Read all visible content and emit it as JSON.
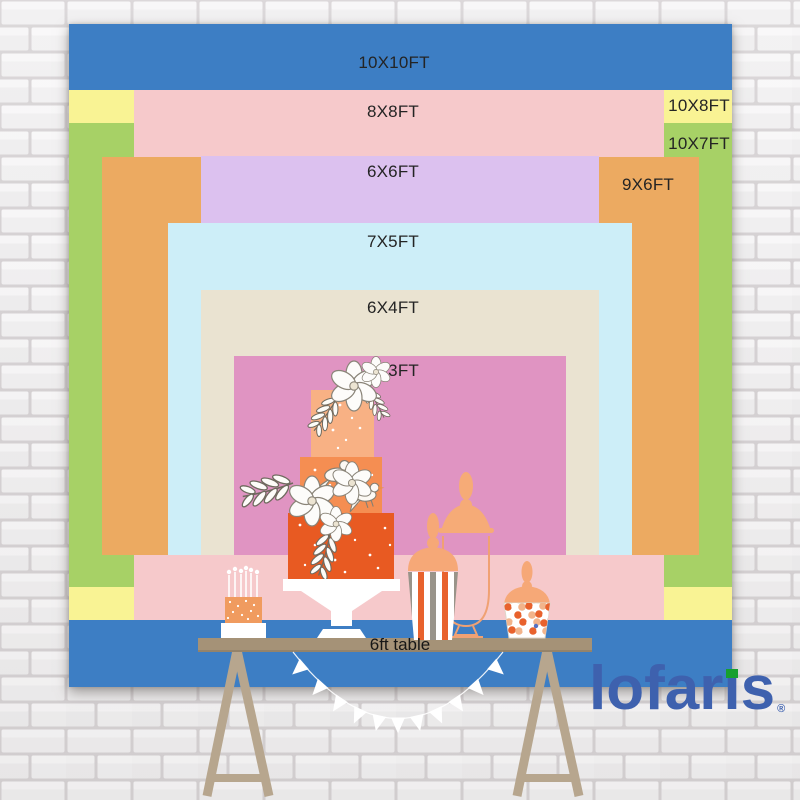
{
  "title": "Backdrop size comparison chart",
  "backdrops": [
    {
      "id": "10x10ft",
      "label": "10X10FT",
      "color": "#3d7ec4",
      "x": 69,
      "y": 24,
      "w": 663,
      "h": 663,
      "lx": 394,
      "ly": 63
    },
    {
      "id": "10x8ft",
      "label": "10X8FT",
      "color": "#f9f394",
      "x": 69,
      "y": 90,
      "w": 663,
      "h": 530,
      "lx": 699,
      "ly": 106
    },
    {
      "id": "10x7ft",
      "label": "10X7FT",
      "color": "#a7d166",
      "x": 69,
      "y": 123,
      "w": 663,
      "h": 464,
      "lx": 699,
      "ly": 144
    },
    {
      "id": "8x8ft",
      "label": "8X8FT",
      "color": "#f6c9cb",
      "x": 134,
      "y": 90,
      "w": 530,
      "h": 530,
      "lx": 393,
      "ly": 112
    },
    {
      "id": "9x6ft",
      "label": "9X6FT",
      "color": "#ecaa61",
      "x": 102,
      "y": 157,
      "w": 597,
      "h": 398,
      "lx": 648,
      "ly": 185
    },
    {
      "id": "6x6ft",
      "label": "6X6FT",
      "color": "#dcc1ef",
      "x": 201,
      "y": 156,
      "w": 398,
      "h": 399,
      "lx": 393,
      "ly": 172
    },
    {
      "id": "7x5ft",
      "label": "7X5FT",
      "color": "#cdeef8",
      "x": 168,
      "y": 223,
      "w": 464,
      "h": 332,
      "lx": 393,
      "ly": 242
    },
    {
      "id": "6x4ft",
      "label": "6X4FT",
      "color": "#eae3d1",
      "x": 201,
      "y": 290,
      "w": 398,
      "h": 265,
      "lx": 393,
      "ly": 308
    },
    {
      "id": "5x3ft",
      "label": "5X3FT",
      "color": "#e094c2",
      "x": 234,
      "y": 356,
      "w": 332,
      "h": 199,
      "lx": 393,
      "ly": 371
    }
  ],
  "table": {
    "label": "6ft table"
  },
  "logo": {
    "word": "lofaris",
    "part1": "lofar",
    "part2": "ı",
    "part3": "s",
    "reg": "®",
    "color": "#3e61ae",
    "dot_color": "#17a02e"
  },
  "colors": {
    "wall_brick": "#f0eff0",
    "wall_mortar": "#d6d2d4",
    "table_top": "#a59277",
    "table_legs": "#b7a68e",
    "cake_tier_top": "#f8b184",
    "cake_tier_mid": "#f58e52",
    "cake_tier_bottom": "#e85a22",
    "jar_orange": "#f6a877",
    "stripe_orange": "#e8622d",
    "stripe_gray": "#99948a",
    "bunting": "#ffffff",
    "label_text": "#242424"
  }
}
